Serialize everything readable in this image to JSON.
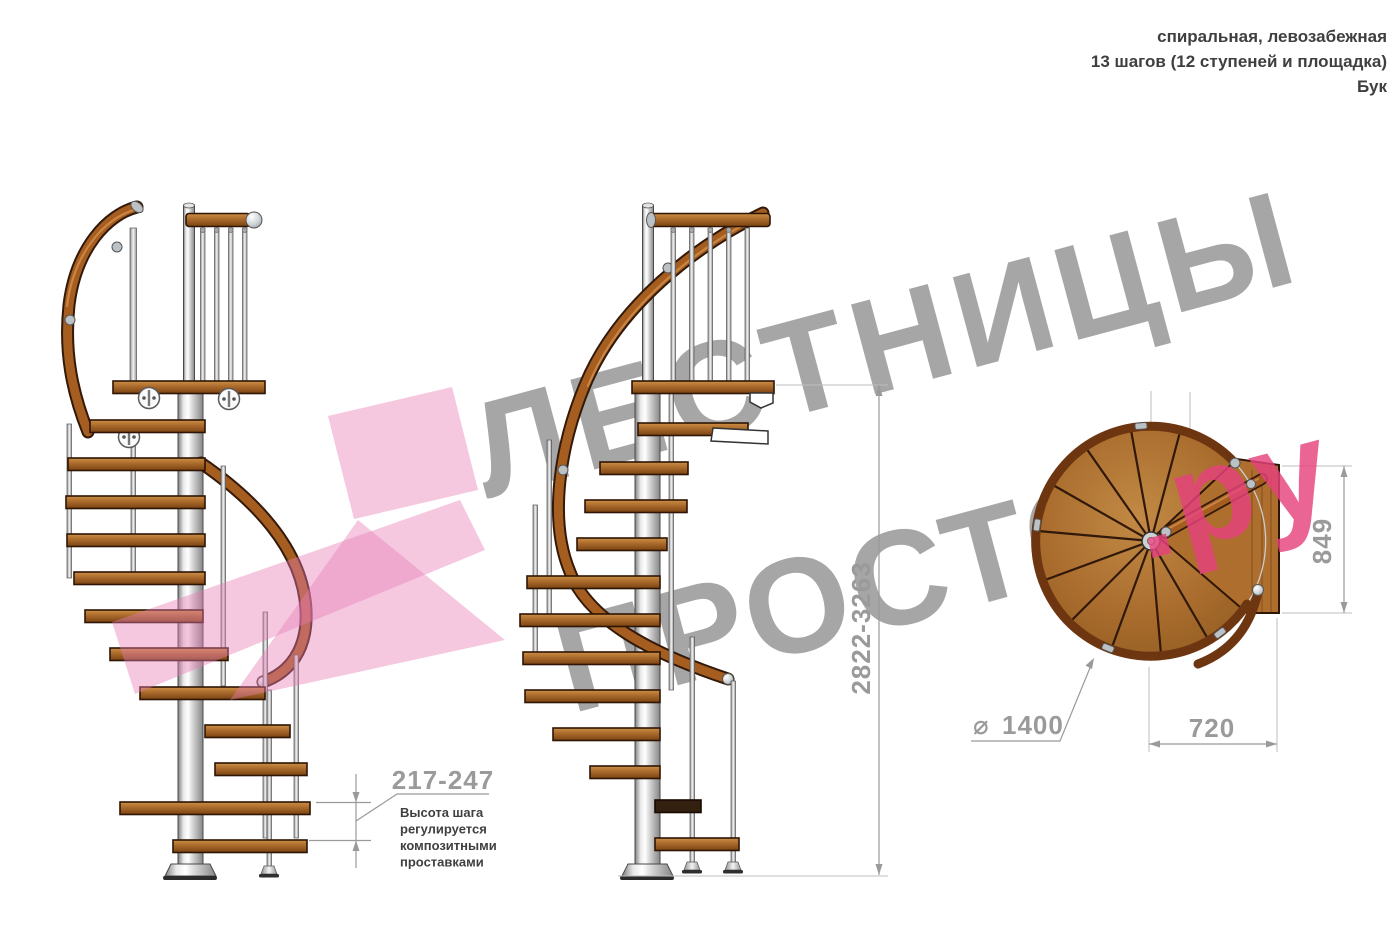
{
  "header": {
    "line1": "спиральная, левозабежная",
    "line2": "13 шагов (12 ступеней и площадка)",
    "line3": "Бук"
  },
  "watermark": {
    "line1": "ЛЕСТНИЦЫ",
    "line2_gray": "ПРОСТО",
    "line2_pink": ".ру",
    "gray_color": "#a6a6a6",
    "pink_color": "#e5427d",
    "arrow_color": "#e87bb4"
  },
  "dimensions": {
    "step_height": {
      "value": "217-247",
      "note_lines": [
        "Высота шага",
        "регулируется",
        "композитными",
        "проставками"
      ]
    },
    "total_height": "2822-3263",
    "platform_depth": "849",
    "platform_width": "720",
    "diameter": {
      "symbol": "⌀",
      "value": "1400"
    }
  }
}
